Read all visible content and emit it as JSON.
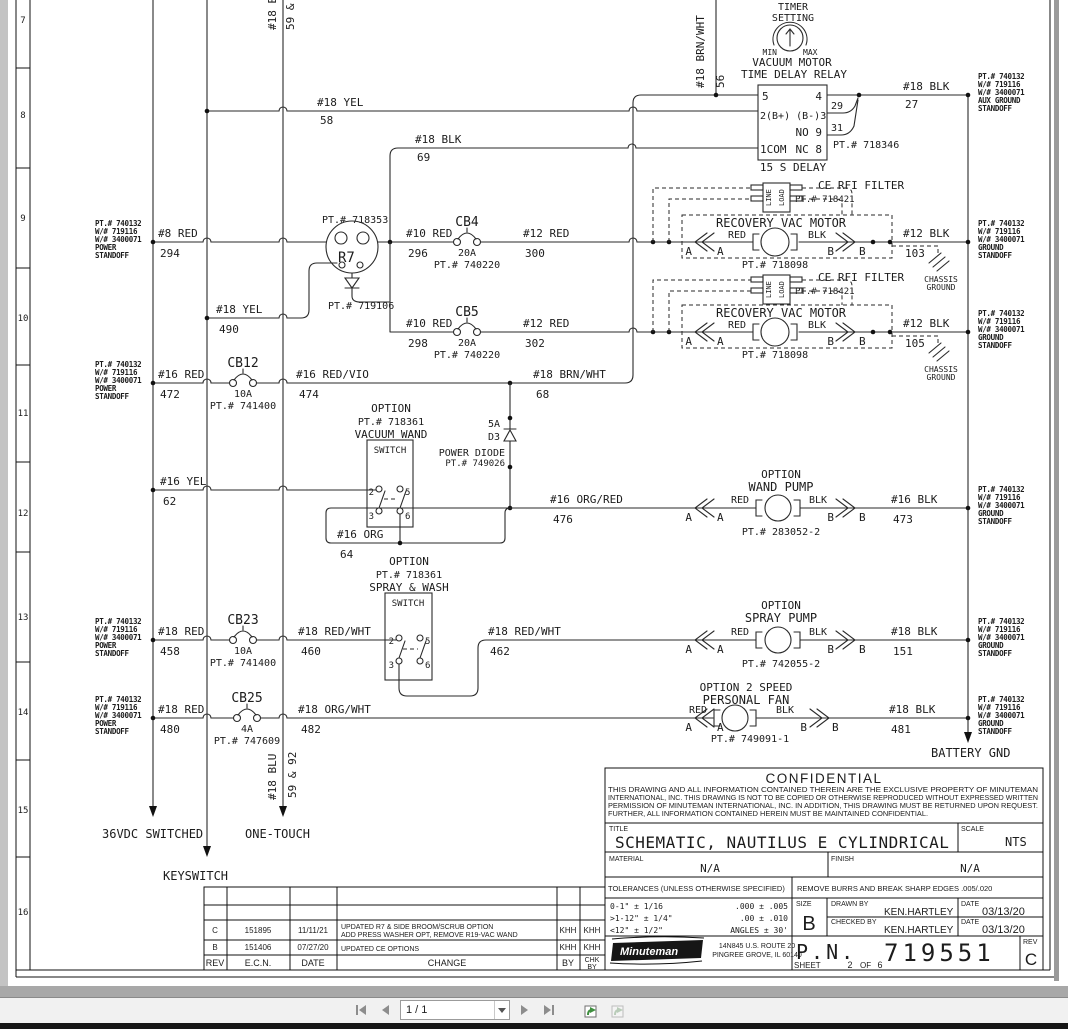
{
  "toolbar": {
    "page_indicator": "1 / 1"
  },
  "rows": [
    "7",
    "8",
    "9",
    "10",
    "11",
    "12",
    "13",
    "14",
    "15",
    "16"
  ],
  "rails": {
    "switched": "36VDC SWITCHED",
    "one_touch": "ONE-TOUCH",
    "keyswitch": "KEYSWITCH",
    "battery_gnd": "BATTERY GND"
  },
  "standoffs": {
    "power": {
      "pt": "PT.# 740132",
      "w1": "W/# 719116",
      "w2": "W/# 3400071",
      "l1": "POWER",
      "l2": "STANDOFF"
    },
    "aux": {
      "pt": "PT.# 740132",
      "w1": "W/# 719116",
      "w2": "W/# 3400071",
      "l1": "AUX GROUND",
      "l2": "STANDOFF"
    },
    "ground": {
      "pt": "PT.# 740132",
      "w1": "W/# 719116",
      "w2": "W/# 3400071",
      "l1": "GROUND",
      "l2": "STANDOFF"
    }
  },
  "timer": {
    "l1": "TIMER",
    "l2": "SETTING",
    "min": "MIN",
    "max": "MAX"
  },
  "relay": {
    "title1": "VACUUM MOTOR",
    "title2": "TIME DELAY RELAY",
    "pin5": "5",
    "pin4": "4",
    "row2": "2(B+) (B-)3",
    "row3": "NO 9",
    "row4l": "1COM",
    "row4r": "NC 8",
    "tap29": "29",
    "tap31": "31",
    "pt": "PT.# 718346",
    "delay": "15 S DELAY"
  },
  "r7": {
    "pt": "PT.# 718353",
    "label": "R7",
    "pt2": "PT.# 719106"
  },
  "cb4": {
    "label": "CB4",
    "amp": "20A",
    "pt": "PT.# 740220"
  },
  "cb5": {
    "label": "CB5",
    "amp": "20A",
    "pt": "PT.# 740220"
  },
  "cb12": {
    "label": "CB12",
    "amp": "10A",
    "pt": "PT.# 741400"
  },
  "cb23": {
    "label": "CB23",
    "amp": "10A",
    "pt": "PT.# 741400"
  },
  "cb25": {
    "label": "CB25",
    "amp": "4A",
    "pt": "PT.# 747609"
  },
  "rfi": {
    "label": "CE RFI FILTER",
    "pt": "PT.# 718421",
    "line": "LINE",
    "load": "LOAD"
  },
  "motor": {
    "label": "RECOVERY VAC MOTOR",
    "pt": "PT.# 718098"
  },
  "conn": {
    "a": "A",
    "b": "B",
    "red": "RED",
    "blk": "BLK"
  },
  "chassis": {
    "l1": "CHASSIS",
    "l2": "GROUND"
  },
  "d3": {
    "amp": "5A",
    "label": "D3",
    "name": "POWER DIODE",
    "pt": "PT.# 749026"
  },
  "wand_switch": {
    "option": "OPTION",
    "pt": "PT.# 718361",
    "name": "VACUUM WAND",
    "sw": "SWITCH",
    "p2": "2",
    "p5": "5",
    "p3": "3",
    "p6": "6"
  },
  "spray_switch": {
    "option": "OPTION",
    "pt": "PT.# 718361",
    "name": "SPRAY & WASH",
    "sw": "SWITCH",
    "p2": "2",
    "p5": "5",
    "p3": "3",
    "p6": "6"
  },
  "wand_pump": {
    "option": "OPTION",
    "name": "WAND PUMP",
    "pt": "PT.# 283052-2"
  },
  "spray_pump": {
    "option": "OPTION",
    "name": "SPRAY PUMP",
    "pt": "PT.# 742055-2"
  },
  "fan": {
    "option": "OPTION 2 SPEED",
    "name": "PERSONAL FAN",
    "pt": "PT.# 749091-1"
  },
  "wires": {
    "w56": {
      "name": "#18 BRN/WHT",
      "num": "56"
    },
    "w58": {
      "name": "#18 YEL",
      "num": "58"
    },
    "w27": {
      "name": "#18 BLK",
      "num": "27"
    },
    "w69": {
      "name": "#18 BLK",
      "num": "69"
    },
    "w294": {
      "name": "#8 RED",
      "num": "294"
    },
    "w296": {
      "name": "#10 RED",
      "num": "296"
    },
    "w300": {
      "name": "#12 RED",
      "num": "300"
    },
    "w103": {
      "name": "#12 BLK",
      "num": "103"
    },
    "w298": {
      "name": "#10 RED",
      "num": "298"
    },
    "w302": {
      "name": "#12 RED",
      "num": "302"
    },
    "w105": {
      "name": "#12 BLK",
      "num": "105"
    },
    "w490": {
      "name": "#18 YEL",
      "num": "490"
    },
    "w472": {
      "name": "#16 RED",
      "num": "472"
    },
    "w474": {
      "name": "#16 RED/VIO",
      "num": "474"
    },
    "w68": {
      "name": "#18 BRN/WHT",
      "num": "68"
    },
    "w62": {
      "name": "#16 YEL",
      "num": "62"
    },
    "w64": {
      "name": "#16 ORG",
      "num": "64"
    },
    "w476": {
      "name": "#16 ORG/RED",
      "num": "476"
    },
    "w473": {
      "name": "#16 BLK",
      "num": "473"
    },
    "w458": {
      "name": "#18 RED",
      "num": "458"
    },
    "w460": {
      "name": "#18 RED/WHT",
      "num": "460"
    },
    "w462": {
      "name": "#18 RED/WHT",
      "num": "462"
    },
    "w151": {
      "name": "#18 BLK",
      "num": "151"
    },
    "w480": {
      "name": "#18 RED",
      "num": "480"
    },
    "w482": {
      "name": "#18 ORG/WHT",
      "num": "482"
    },
    "w481": {
      "name": "#18 BLK",
      "num": "481"
    },
    "wblu": {
      "name": "#18 BLU",
      "num": "59 & 92"
    }
  },
  "tb": {
    "confidential": "CONFIDENTIAL",
    "c1": "THIS DRAWING AND ALL INFORMATION CONTAINED THEREIN ARE THE EXCLUSIVE PROPERTY OF MINUTEMAN",
    "c2": "INTERNATIONAL, INC. THIS DRAWING IS NOT TO BE COPIED OR OTHERWISE REPRODUCED WITHOUT EXPRESSED WRITTEN",
    "c3": "PERMISSION OF MINUTEMAN INTERNATIONAL, INC. IN ADDITION, THIS DRAWING MUST BE RETURNED UPON REQUEST.",
    "c4": "FURTHER, ALL INFORMATION CONTAINED HEREIN MUST BE MAINTAINED CONFIDENTIAL.",
    "title_label": "TITLE",
    "title": "SCHEMATIC, NAUTILUS E CYLINDRICAL",
    "scale_label": "SCALE",
    "scale": "NTS",
    "material_label": "MATERIAL",
    "material": "N/A",
    "finish_label": "FINISH",
    "finish": "N/A",
    "tol_header": "TOLERANCES (UNLESS OTHERWISE SPECIFIED)",
    "burrs": "REMOVE BURRS AND BREAK SHARP EDGES .005/.020",
    "tol1a": "0-1\"   ± 1/16",
    "tol1b": ".000 ± .005",
    "tol2a": ">1-12\" ± 1/4\"",
    "tol2b": ".00 ± .010",
    "tol3a": "<12\"   ± 1/2\"",
    "tol3b": "ANGLES ± 30'",
    "size_label": "SIZE",
    "size": "B",
    "drawn_label": "DRAWN BY",
    "drawn": "KEN.HARTLEY",
    "date_label": "DATE",
    "drawn_date": "03/13/20",
    "checked_label": "CHECKED BY",
    "checked": "KEN.HARTLEY",
    "checked_date": "03/13/20",
    "company": "Minuteman",
    "addr1": "14N845 U.S. ROUTE 20",
    "addr2": "PINGREE GROVE, IL 60140",
    "pn_label": "P.N.",
    "pn": "719551",
    "sheet_label": "SHEET",
    "sheet_num": "2",
    "sheet_of": "OF",
    "sheet_total": "6",
    "rev_label": "REV",
    "rev": "C"
  },
  "rev_table": {
    "h_rev": "REV",
    "h_ecn": "E.C.N.",
    "h_date": "DATE",
    "h_change": "CHANGE",
    "h_by": "BY",
    "h_chk1": "CHK",
    "h_chk2": "BY",
    "c_rev": "C",
    "c_ecn": "151895",
    "c_date": "11/11/21",
    "c_change1": "UPDATED R7 & SIDE BROOM/SCRUB OPTION",
    "c_change2": "ADD PRESS WASHER OPT, REMOVE R19-VAC WAND",
    "c_by": "KHH",
    "c_chk": "KHH",
    "b_rev": "B",
    "b_ecn": "151406",
    "b_date": "07/27/20",
    "b_change": "UPDATED CE OPTIONS",
    "b_by": "KHH",
    "b_chk": "KHH"
  }
}
